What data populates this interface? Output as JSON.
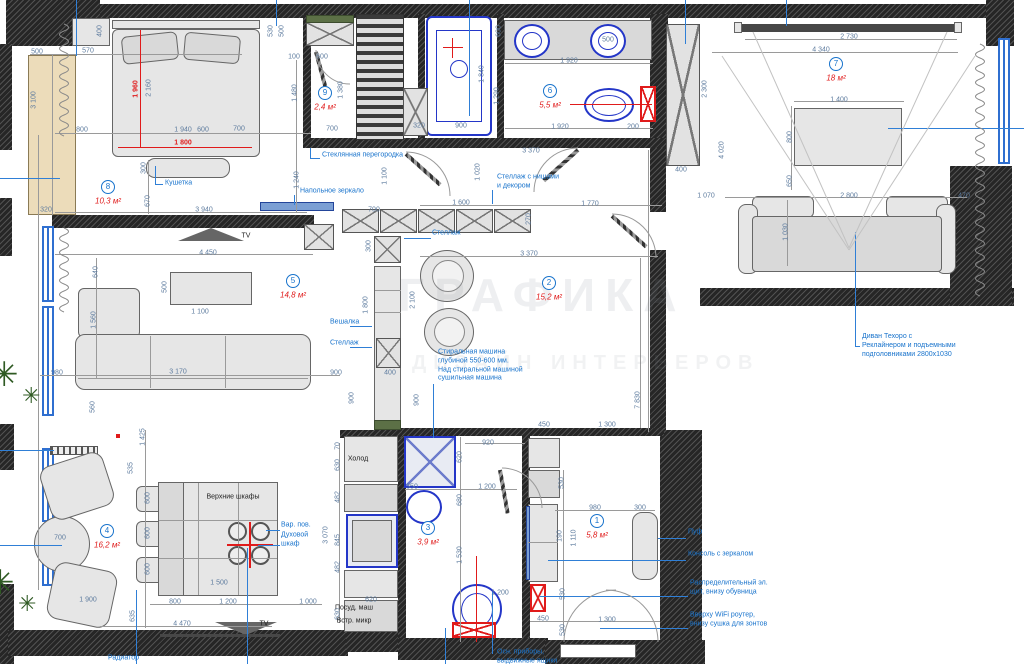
{
  "watermark": {
    "line1": "ГРАФИКА",
    "line2": "ДИЗАЙН ИНТЕРЬЕРОВ"
  },
  "icons": {
    "plant": "✳"
  },
  "rooms": [
    {
      "num": "1",
      "area": "5,8 м²",
      "x": 597,
      "y": 521
    },
    {
      "num": "2",
      "area": "15,2 м²",
      "x": 549,
      "y": 283
    },
    {
      "num": "3",
      "area": "3,9 м²",
      "x": 428,
      "y": 528
    },
    {
      "num": "4",
      "area": "16,2 м²",
      "x": 107,
      "y": 531
    },
    {
      "num": "5",
      "area": "14,8 м²",
      "x": 293,
      "y": 281
    },
    {
      "num": "6",
      "area": "5,5 м²",
      "x": 550,
      "y": 91
    },
    {
      "num": "7",
      "area": "18 м²",
      "x": 836,
      "y": 64
    },
    {
      "num": "8",
      "area": "10,3 м²",
      "x": 108,
      "y": 187
    },
    {
      "num": "9",
      "area": "2,4 м²",
      "x": 325,
      "y": 93
    }
  ],
  "dims": [
    {
      "t": "500",
      "x": 37,
      "y": 52
    },
    {
      "t": "570",
      "x": 88,
      "y": 51
    },
    {
      "t": "400",
      "x": 100,
      "y": 31,
      "r": 1
    },
    {
      "t": "3 100",
      "x": 34,
      "y": 100,
      "r": 1
    },
    {
      "t": "1 960",
      "x": 136,
      "y": 89,
      "r": 1,
      "c": "r"
    },
    {
      "t": "2 160",
      "x": 149,
      "y": 88,
      "r": 1
    },
    {
      "t": "800",
      "x": 82,
      "y": 130
    },
    {
      "t": "1 940",
      "x": 183,
      "y": 130
    },
    {
      "t": "1 800",
      "x": 183,
      "y": 143,
      "c": "r"
    },
    {
      "t": "600",
      "x": 203,
      "y": 130
    },
    {
      "t": "700",
      "x": 239,
      "y": 129
    },
    {
      "t": "300",
      "x": 144,
      "y": 168,
      "r": 1
    },
    {
      "t": "670",
      "x": 148,
      "y": 201,
      "r": 1
    },
    {
      "t": "3 940",
      "x": 204,
      "y": 210
    },
    {
      "t": "320",
      "x": 46,
      "y": 210
    },
    {
      "t": "1 240",
      "x": 297,
      "y": 180,
      "r": 1
    },
    {
      "t": "1 480",
      "x": 295,
      "y": 93,
      "r": 1
    },
    {
      "t": "100",
      "x": 294,
      "y": 57
    },
    {
      "t": "600",
      "x": 322,
      "y": 57
    },
    {
      "t": "530",
      "x": 271,
      "y": 31,
      "r": 1
    },
    {
      "t": "500",
      "x": 282,
      "y": 31,
      "r": 1
    },
    {
      "t": "1 380",
      "x": 341,
      "y": 90,
      "r": 1
    },
    {
      "t": "700",
      "x": 332,
      "y": 129
    },
    {
      "t": "600",
      "x": 499,
      "y": 31,
      "r": 1
    },
    {
      "t": "1 840",
      "x": 482,
      "y": 74,
      "r": 1
    },
    {
      "t": "900",
      "x": 461,
      "y": 126
    },
    {
      "t": "320",
      "x": 419,
      "y": 126
    },
    {
      "t": "1 920",
      "x": 569,
      "y": 61
    },
    {
      "t": "1 290",
      "x": 497,
      "y": 96,
      "r": 1
    },
    {
      "t": "500",
      "x": 608,
      "y": 40
    },
    {
      "t": "1 920",
      "x": 560,
      "y": 127
    },
    {
      "t": "200",
      "x": 633,
      "y": 127
    },
    {
      "t": "1 100",
      "x": 385,
      "y": 176,
      "r": 1
    },
    {
      "t": "700",
      "x": 374,
      "y": 210
    },
    {
      "t": "1 600",
      "x": 461,
      "y": 203
    },
    {
      "t": "270",
      "x": 529,
      "y": 219,
      "r": 1
    },
    {
      "t": "3 370",
      "x": 531,
      "y": 151
    },
    {
      "t": "1 020",
      "x": 478,
      "y": 172,
      "r": 1
    },
    {
      "t": "1 770",
      "x": 590,
      "y": 204
    },
    {
      "t": "1 070",
      "x": 706,
      "y": 196
    },
    {
      "t": "2 730",
      "x": 849,
      "y": 37
    },
    {
      "t": "4 340",
      "x": 821,
      "y": 50
    },
    {
      "t": "1 400",
      "x": 839,
      "y": 100
    },
    {
      "t": "800",
      "x": 790,
      "y": 137,
      "r": 1
    },
    {
      "t": "650",
      "x": 790,
      "y": 181,
      "r": 1
    },
    {
      "t": "2 800",
      "x": 849,
      "y": 196
    },
    {
      "t": "1 030",
      "x": 786,
      "y": 232,
      "r": 1
    },
    {
      "t": "470",
      "x": 964,
      "y": 196
    },
    {
      "t": "2 300",
      "x": 705,
      "y": 89,
      "r": 1
    },
    {
      "t": "4 020",
      "x": 722,
      "y": 150,
      "r": 1
    },
    {
      "t": "400",
      "x": 681,
      "y": 170
    },
    {
      "t": "4 450",
      "x": 208,
      "y": 253
    },
    {
      "t": "640",
      "x": 96,
      "y": 272,
      "r": 1
    },
    {
      "t": "500",
      "x": 165,
      "y": 287,
      "r": 1
    },
    {
      "t": "1 100",
      "x": 200,
      "y": 312
    },
    {
      "t": "1 560",
      "x": 94,
      "y": 320,
      "r": 1
    },
    {
      "t": "980",
      "x": 57,
      "y": 373
    },
    {
      "t": "3 170",
      "x": 178,
      "y": 372
    },
    {
      "t": "900",
      "x": 336,
      "y": 373
    },
    {
      "t": "560",
      "x": 93,
      "y": 407,
      "r": 1
    },
    {
      "t": "1 425",
      "x": 143,
      "y": 437,
      "r": 1
    },
    {
      "t": "300",
      "x": 369,
      "y": 246,
      "r": 1
    },
    {
      "t": "1 800",
      "x": 366,
      "y": 305,
      "r": 1
    },
    {
      "t": "2 100",
      "x": 413,
      "y": 300,
      "r": 1
    },
    {
      "t": "900",
      "x": 352,
      "y": 398,
      "r": 1
    },
    {
      "t": "400",
      "x": 390,
      "y": 373
    },
    {
      "t": "900",
      "x": 417,
      "y": 400,
      "r": 1
    },
    {
      "t": "7 830",
      "x": 638,
      "y": 400,
      "r": 1
    },
    {
      "t": "450",
      "x": 544,
      "y": 425
    },
    {
      "t": "1 300",
      "x": 607,
      "y": 425
    },
    {
      "t": "3 370",
      "x": 529,
      "y": 254
    },
    {
      "t": "535",
      "x": 131,
      "y": 468,
      "r": 1
    },
    {
      "t": "600",
      "x": 148,
      "y": 498,
      "r": 1
    },
    {
      "t": "600",
      "x": 148,
      "y": 533,
      "r": 1
    },
    {
      "t": "600",
      "x": 148,
      "y": 569,
      "r": 1
    },
    {
      "t": "1 900",
      "x": 88,
      "y": 600
    },
    {
      "t": "700",
      "x": 60,
      "y": 538
    },
    {
      "t": "1 500",
      "x": 219,
      "y": 583
    },
    {
      "t": "800",
      "x": 175,
      "y": 602
    },
    {
      "t": "1 200",
      "x": 228,
      "y": 602
    },
    {
      "t": "1 000",
      "x": 308,
      "y": 602
    },
    {
      "t": "635",
      "x": 133,
      "y": 616,
      "r": 1
    },
    {
      "t": "4 470",
      "x": 182,
      "y": 624
    },
    {
      "t": "3 070",
      "x": 326,
      "y": 535,
      "r": 1
    },
    {
      "t": "70",
      "x": 338,
      "y": 446,
      "r": 1
    },
    {
      "t": "630",
      "x": 338,
      "y": 465,
      "r": 1
    },
    {
      "t": "482",
      "x": 338,
      "y": 497,
      "r": 1
    },
    {
      "t": "845",
      "x": 338,
      "y": 540,
      "r": 1
    },
    {
      "t": "482",
      "x": 338,
      "y": 567,
      "r": 1
    },
    {
      "t": "630",
      "x": 338,
      "y": 614,
      "r": 1
    },
    {
      "t": "620",
      "x": 371,
      "y": 600
    },
    {
      "t": "920",
      "x": 488,
      "y": 443
    },
    {
      "t": "620",
      "x": 460,
      "y": 457,
      "r": 1
    },
    {
      "t": "350",
      "x": 412,
      "y": 487
    },
    {
      "t": "1 200",
      "x": 487,
      "y": 487
    },
    {
      "t": "680",
      "x": 460,
      "y": 500,
      "r": 1
    },
    {
      "t": "1 530",
      "x": 460,
      "y": 555,
      "r": 1
    },
    {
      "t": "1 200",
      "x": 500,
      "y": 593
    },
    {
      "t": "980",
      "x": 595,
      "y": 508
    },
    {
      "t": "300",
      "x": 640,
      "y": 508
    },
    {
      "t": "530",
      "x": 562,
      "y": 483,
      "r": 1
    },
    {
      "t": "190",
      "x": 560,
      "y": 536,
      "r": 1
    },
    {
      "t": "1 110",
      "x": 574,
      "y": 538,
      "r": 1
    },
    {
      "t": "530",
      "x": 563,
      "y": 594,
      "r": 1
    },
    {
      "t": "450",
      "x": 543,
      "y": 619
    },
    {
      "t": "1 300",
      "x": 607,
      "y": 620
    },
    {
      "t": "530",
      "x": 563,
      "y": 630,
      "r": 1
    }
  ],
  "callouts": [
    {
      "t": "Стеклянная перегородка",
      "x": 322,
      "y": 156
    },
    {
      "t": "Напольное зеркало",
      "x": 300,
      "y": 192
    },
    {
      "t": "Кушетка",
      "x": 165,
      "y": 184
    },
    {
      "t": "Стеллаж",
      "x": 432,
      "y": 234
    },
    {
      "t": "Стеллаж с нишами\nи декором",
      "x": 497,
      "y": 182
    },
    {
      "t": "Вешалка",
      "x": 330,
      "y": 323
    },
    {
      "t": "Стеллаж",
      "x": 330,
      "y": 344
    },
    {
      "t": "Стиральная машина\nглубиной 550-600 мм.\nНад стиральной машиной\nсушильная машина",
      "x": 438,
      "y": 366
    },
    {
      "t": "Вар. пов.",
      "x": 281,
      "y": 526
    },
    {
      "t": "Духовой\nшкаф",
      "x": 281,
      "y": 540
    },
    {
      "t": "Пуф",
      "x": 688,
      "y": 533
    },
    {
      "t": "Консоль с зеркалом",
      "x": 688,
      "y": 555
    },
    {
      "t": "Распределительный эл.\nщит, внизу обувница",
      "x": 690,
      "y": 588
    },
    {
      "t": "Вверху WiFi роутер,\nвнизу сушка для зонтов",
      "x": 690,
      "y": 620
    },
    {
      "t": "Диван Техоро с\nРеклайнером и подъемными\nподголовниками 2800х1030",
      "x": 862,
      "y": 346
    },
    {
      "t": "Радиатор",
      "x": 108,
      "y": 659
    },
    {
      "t": "Осн. приборы,\nвыдвижные ящики",
      "x": 497,
      "y": 657
    }
  ],
  "labels": [
    {
      "t": "TV",
      "x": 246,
      "y": 236
    },
    {
      "t": "TV",
      "x": 264,
      "y": 624
    },
    {
      "t": "Верхние шкафы",
      "x": 233,
      "y": 497
    },
    {
      "t": "Холод",
      "x": 358,
      "y": 459
    },
    {
      "t": "Посуд. маш",
      "x": 354,
      "y": 608
    },
    {
      "t": "Встр. микр",
      "x": 354,
      "y": 621
    }
  ]
}
